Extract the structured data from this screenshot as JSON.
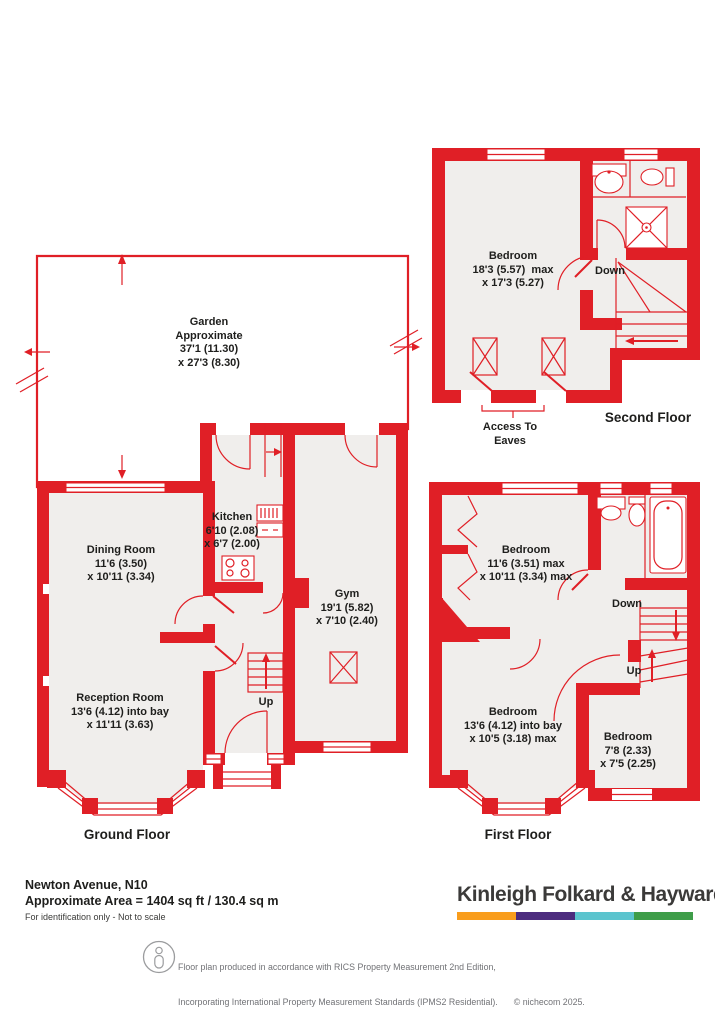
{
  "ground_floor": {
    "label": "Ground Floor",
    "garden": {
      "name": "Garden",
      "line2": "Approximate",
      "dim1": "37'1 (11.30)",
      "dim2": "x 27'3 (8.30)"
    },
    "rooms": [
      {
        "name": "Dining Room",
        "dim1": "11'6 (3.50)",
        "dim2": "x 10'11 (3.34)"
      },
      {
        "name": "Kitchen",
        "dim1": "6'10 (2.08)",
        "dim2": "x 6'7 (2.00)"
      },
      {
        "name": "Gym",
        "dim1": "19'1 (5.82)",
        "dim2": "x 7'10 (2.40)"
      },
      {
        "name": "Reception Room",
        "dim1": "13'6 (4.12) into bay",
        "dim2": "x 11'11 (3.63)"
      }
    ],
    "up_label": "Up"
  },
  "first_floor": {
    "label": "First Floor",
    "rooms": [
      {
        "name": "Bedroom",
        "dim1": "11'6 (3.51) max",
        "dim2": "x 10'11 (3.34) max"
      },
      {
        "name": "Bedroom",
        "dim1": "13'6 (4.12) into bay",
        "dim2": "x 10'5 (3.18) max"
      },
      {
        "name": "Bedroom",
        "dim1": "7'8 (2.33)",
        "dim2": "x 7'5 (2.25)"
      }
    ],
    "down_label": "Down",
    "up_label": "Up"
  },
  "second_floor": {
    "label": "Second Floor",
    "rooms": [
      {
        "name": "Bedroom",
        "dim1": "18'3 (5.57)  max",
        "dim2": "x 17'3 (5.27)"
      }
    ],
    "down_label": "Down",
    "access_line1": "Access To",
    "access_line2": "Eaves"
  },
  "footer": {
    "address": "Newton Avenue, N10",
    "area": "Approximate Area = 1404 sq ft / 130.4 sq m",
    "note": "For identification only - Not to scale",
    "brand": "Kinleigh Folkard & Hayward",
    "brand_colors": [
      "#F99D1C",
      "#4C2C7E",
      "#5BC4CE",
      "#3E9D49"
    ],
    "disclaimer_line1": "Floor plan produced in accordance with RICS Property Measurement 2nd Edition,",
    "disclaimer_line2": "Incorporating International Property Measurement Standards (IPMS2 Residential).",
    "credit": "© nichecom 2025.",
    "disclaimer_line3": "Produced for Kinleigh Folkard & Hayward.   REF: 1373094"
  },
  "colors": {
    "wall_red": "#e01f26",
    "room_fill": "#f0eeec",
    "text": "#1e1e1c"
  }
}
